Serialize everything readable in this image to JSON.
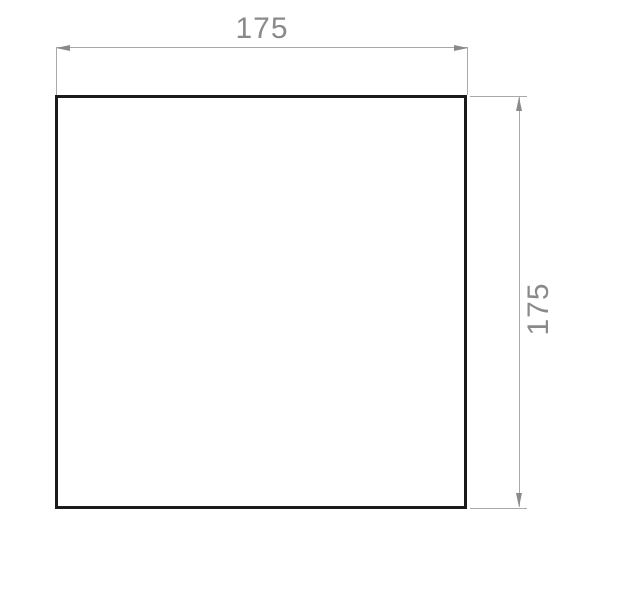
{
  "drawing": {
    "shape": "square",
    "colors": {
      "background": "#ffffff",
      "outline": "#1b1b1b",
      "dimension_lines": "#a9a9a9",
      "dimension_text": "#8a8a8a"
    },
    "dimensions": {
      "horizontal": {
        "label": "175",
        "value": 175
      },
      "vertical": {
        "label": "175",
        "value": 175
      }
    }
  }
}
